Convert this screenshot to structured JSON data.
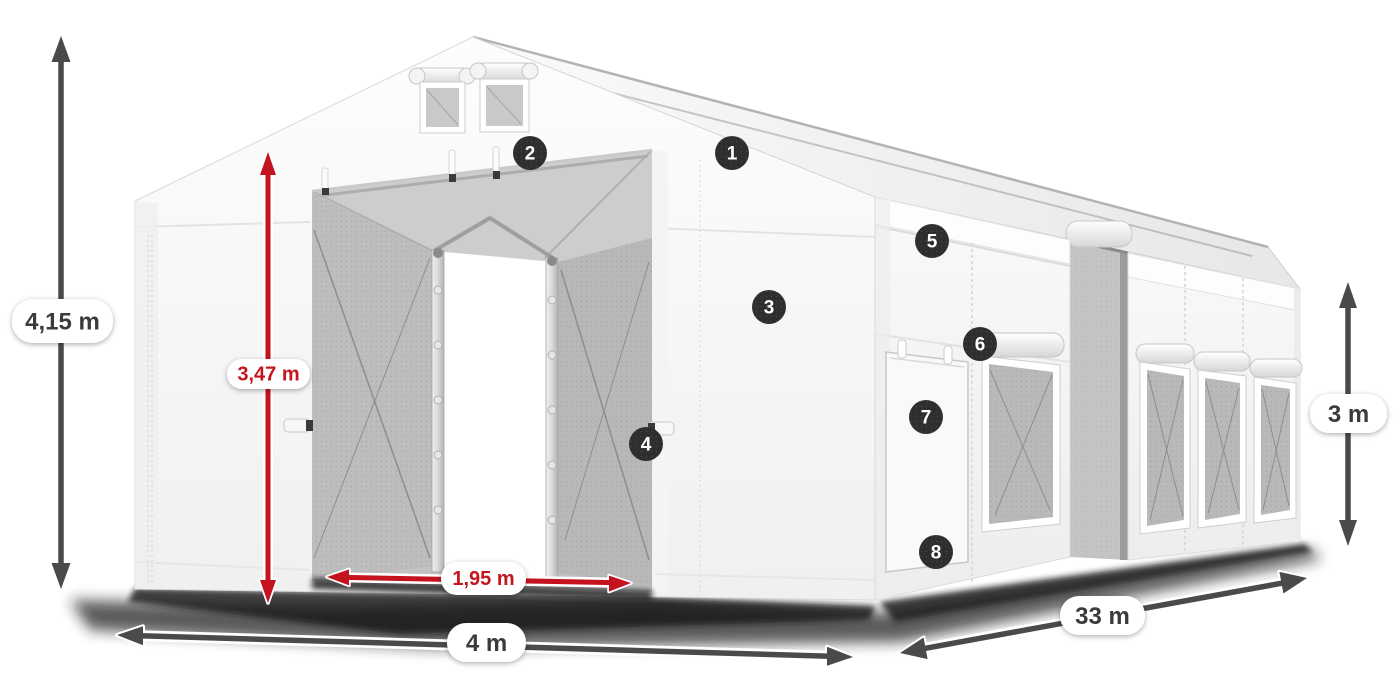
{
  "diagram": {
    "name": "tent-dimensions-diagram",
    "subject": "white storage tent with numbered feature markers and dimension arrows",
    "dimensions": {
      "total_height": {
        "label": "4,15 m",
        "color": "#4a4a4a",
        "orientation": "vertical"
      },
      "inner_height": {
        "label": "3,47 m",
        "color": "#c4121f",
        "orientation": "vertical"
      },
      "door_width": {
        "label": "1,95 m",
        "color": "#c4121f",
        "orientation": "horizontal"
      },
      "front_width": {
        "label": "4 m",
        "color": "#4a4a4a",
        "orientation": "horizontal"
      },
      "length": {
        "label": "33 m",
        "color": "#4a4a4a",
        "orientation": "diagonal"
      },
      "side_height": {
        "label": "3 m",
        "color": "#4a4a4a",
        "orientation": "vertical"
      }
    },
    "markers": [
      {
        "number": "1"
      },
      {
        "number": "2"
      },
      {
        "number": "3"
      },
      {
        "number": "4"
      },
      {
        "number": "5"
      },
      {
        "number": "6"
      },
      {
        "number": "7"
      },
      {
        "number": "8"
      }
    ],
    "marker_style": {
      "background": "#2e2e2e",
      "text": "#ffffff"
    },
    "label_pill": {
      "background": "#ffffff",
      "text": "#3b3b3b"
    }
  }
}
